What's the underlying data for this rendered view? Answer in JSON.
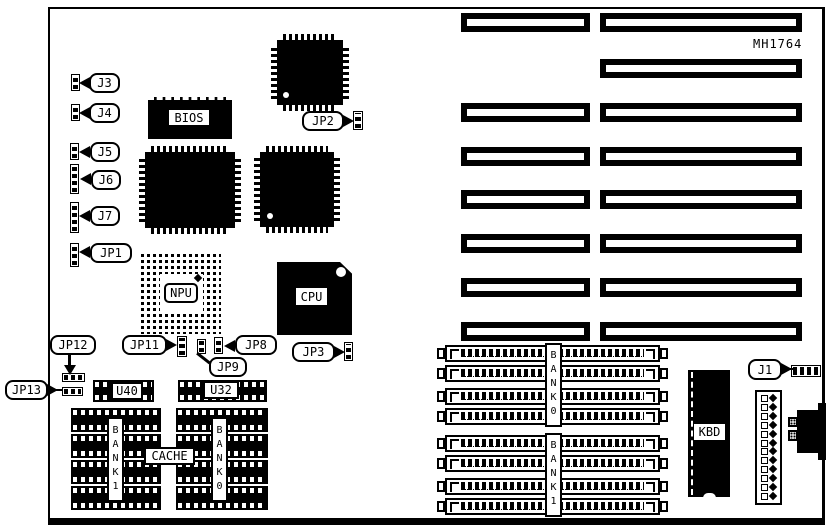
{
  "board": {
    "part_number": "MH1764"
  },
  "jumpers": {
    "j3": "J3",
    "j4": "J4",
    "j5": "J5",
    "j6": "J6",
    "j7": "J7",
    "jp1": "JP1",
    "jp2": "JP2",
    "jp3": "JP3",
    "jp8": "JP8",
    "jp9": "JP9",
    "jp11": "JP11",
    "jp12": "JP12",
    "jp13": "JP13",
    "j1": "J1"
  },
  "chips": {
    "bios": "BIOS",
    "npu": "NPU",
    "cpu": "CPU",
    "kbd": "KBD",
    "u40": "U40",
    "u32": "U32",
    "cache": "CACHE"
  },
  "memory_banks": {
    "cache_left": "BANK1",
    "cache_right": "BANK0",
    "simm_top": "BANK0",
    "simm_bottom": "BANK1"
  },
  "colors": {
    "ink": "#000000",
    "paper": "#ffffff"
  }
}
